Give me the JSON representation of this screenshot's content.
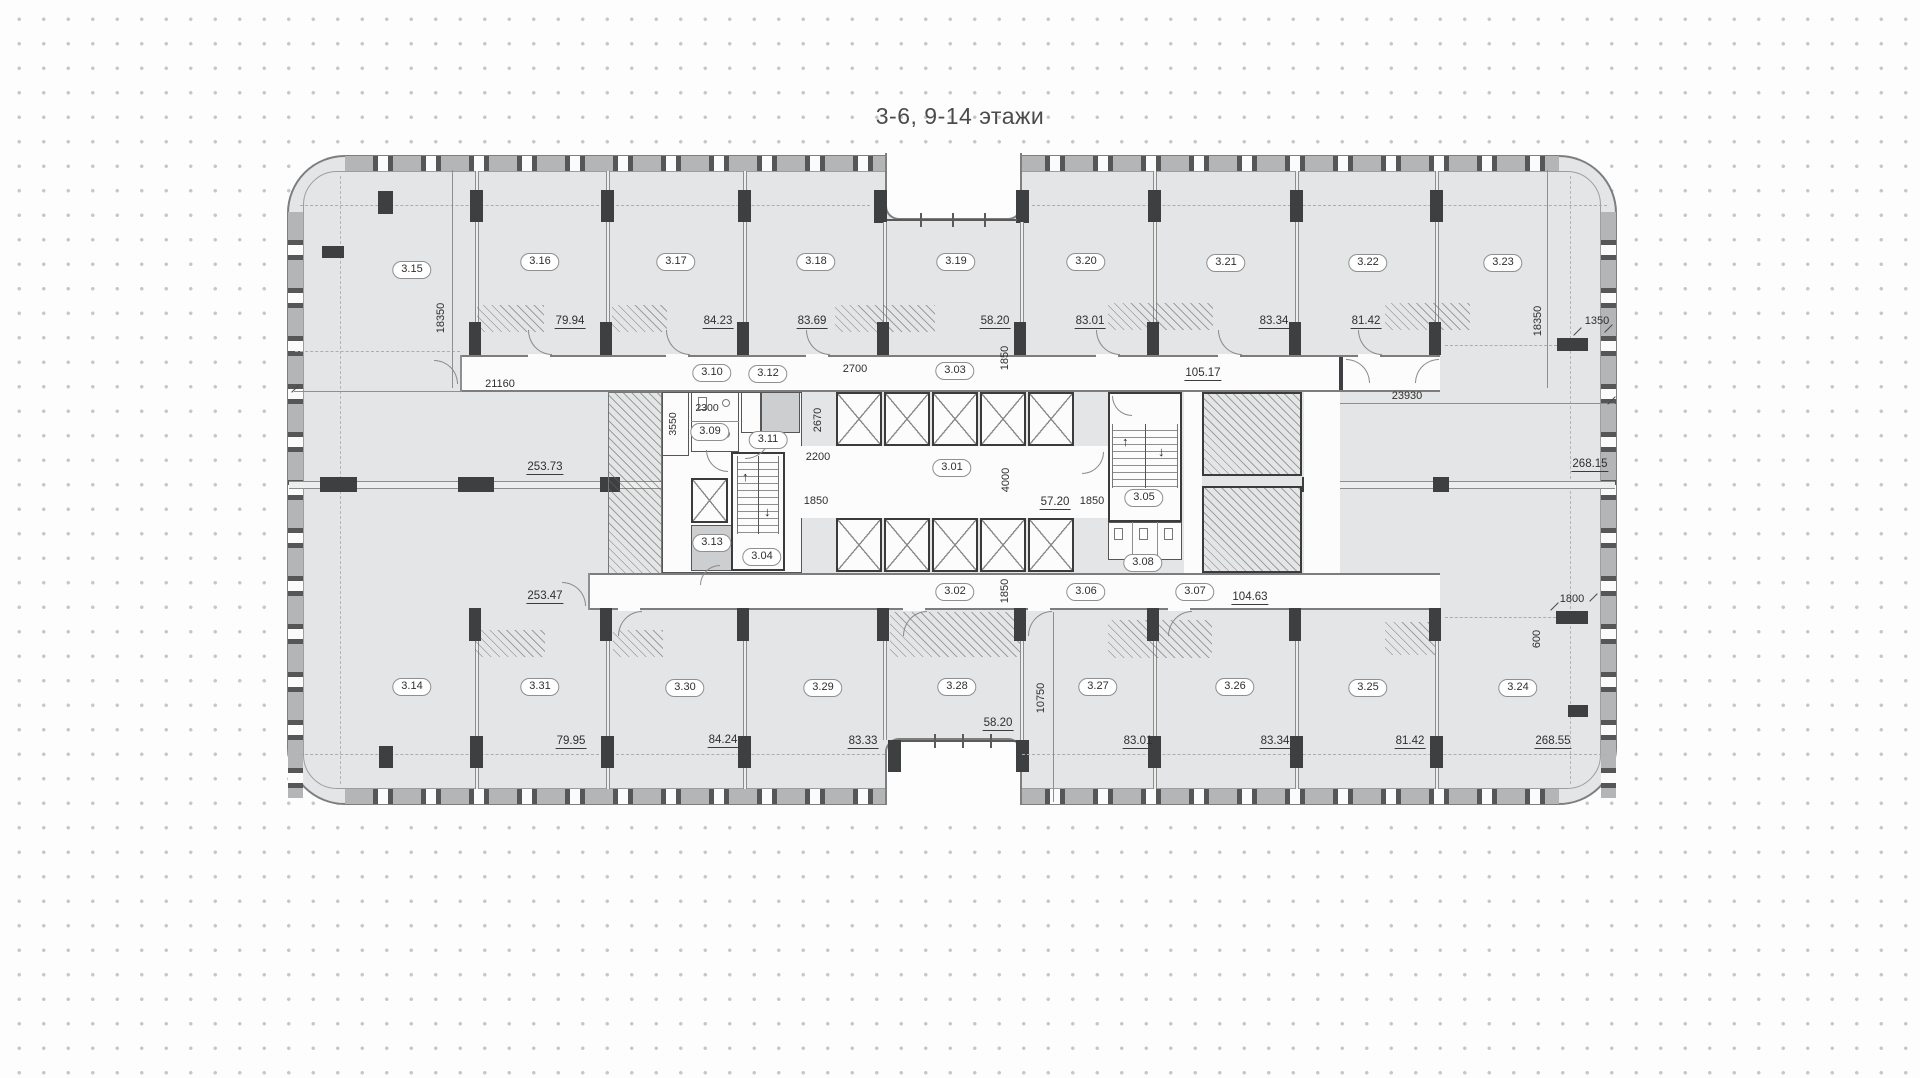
{
  "title": "3-6, 9-14 этажи",
  "rooms_top": [
    {
      "id": "3.15",
      "area": "253.73"
    },
    {
      "id": "3.16",
      "area": "79.94"
    },
    {
      "id": "3.17",
      "area": "84.23"
    },
    {
      "id": "3.18",
      "area": "83.69"
    },
    {
      "id": "3.19",
      "area": "58.20"
    },
    {
      "id": "3.20",
      "area": "83.01"
    },
    {
      "id": "3.21",
      "area": "83.34"
    },
    {
      "id": "3.22",
      "area": "81.42"
    },
    {
      "id": "3.23",
      "area": "268.15"
    }
  ],
  "rooms_bottom": [
    {
      "id": "3.14",
      "area": "253.47"
    },
    {
      "id": "3.31",
      "area": "79.95"
    },
    {
      "id": "3.30",
      "area": "84.24"
    },
    {
      "id": "3.29",
      "area": "83.33"
    },
    {
      "id": "3.28",
      "area": "58.20"
    },
    {
      "id": "3.27",
      "area": "83.01"
    },
    {
      "id": "3.26",
      "area": "83.34"
    },
    {
      "id": "3.25",
      "area": "81.42"
    },
    {
      "id": "3.24",
      "area": "268.55"
    }
  ],
  "core": {
    "r301": {
      "id": "3.01",
      "area": "57.20"
    },
    "r302": {
      "id": "3.02"
    },
    "r303": {
      "id": "3.03"
    },
    "r304": {
      "id": "3.04"
    },
    "r305": {
      "id": "3.05"
    },
    "r306": {
      "id": "3.06"
    },
    "r307": {
      "id": "3.07"
    },
    "r308": {
      "id": "3.08"
    },
    "r309": {
      "id": "3.09"
    },
    "r310": {
      "id": "3.10"
    },
    "r311": {
      "id": "3.11"
    },
    "r312": {
      "id": "3.12"
    },
    "r313": {
      "id": "3.13"
    }
  },
  "corridor": {
    "top_area": "105.17",
    "bottom_area": "104.63"
  },
  "dims": {
    "h18350": "18350",
    "w21160": "21160",
    "w23930": "23930",
    "o1350": "1350",
    "p1800": "1800",
    "p600": "600",
    "v10750": "10750",
    "c2300": "2300",
    "c3550": "3550",
    "c2700": "2700",
    "c2670": "2670",
    "c2200": "2200",
    "c4000": "4000",
    "c1850": "1850"
  },
  "colors": {
    "room_fill": "#e4e5e6",
    "wall_dark": "#3e3f40",
    "outline": "#7e7e7e",
    "dot_grid": "#c7c7c7"
  }
}
